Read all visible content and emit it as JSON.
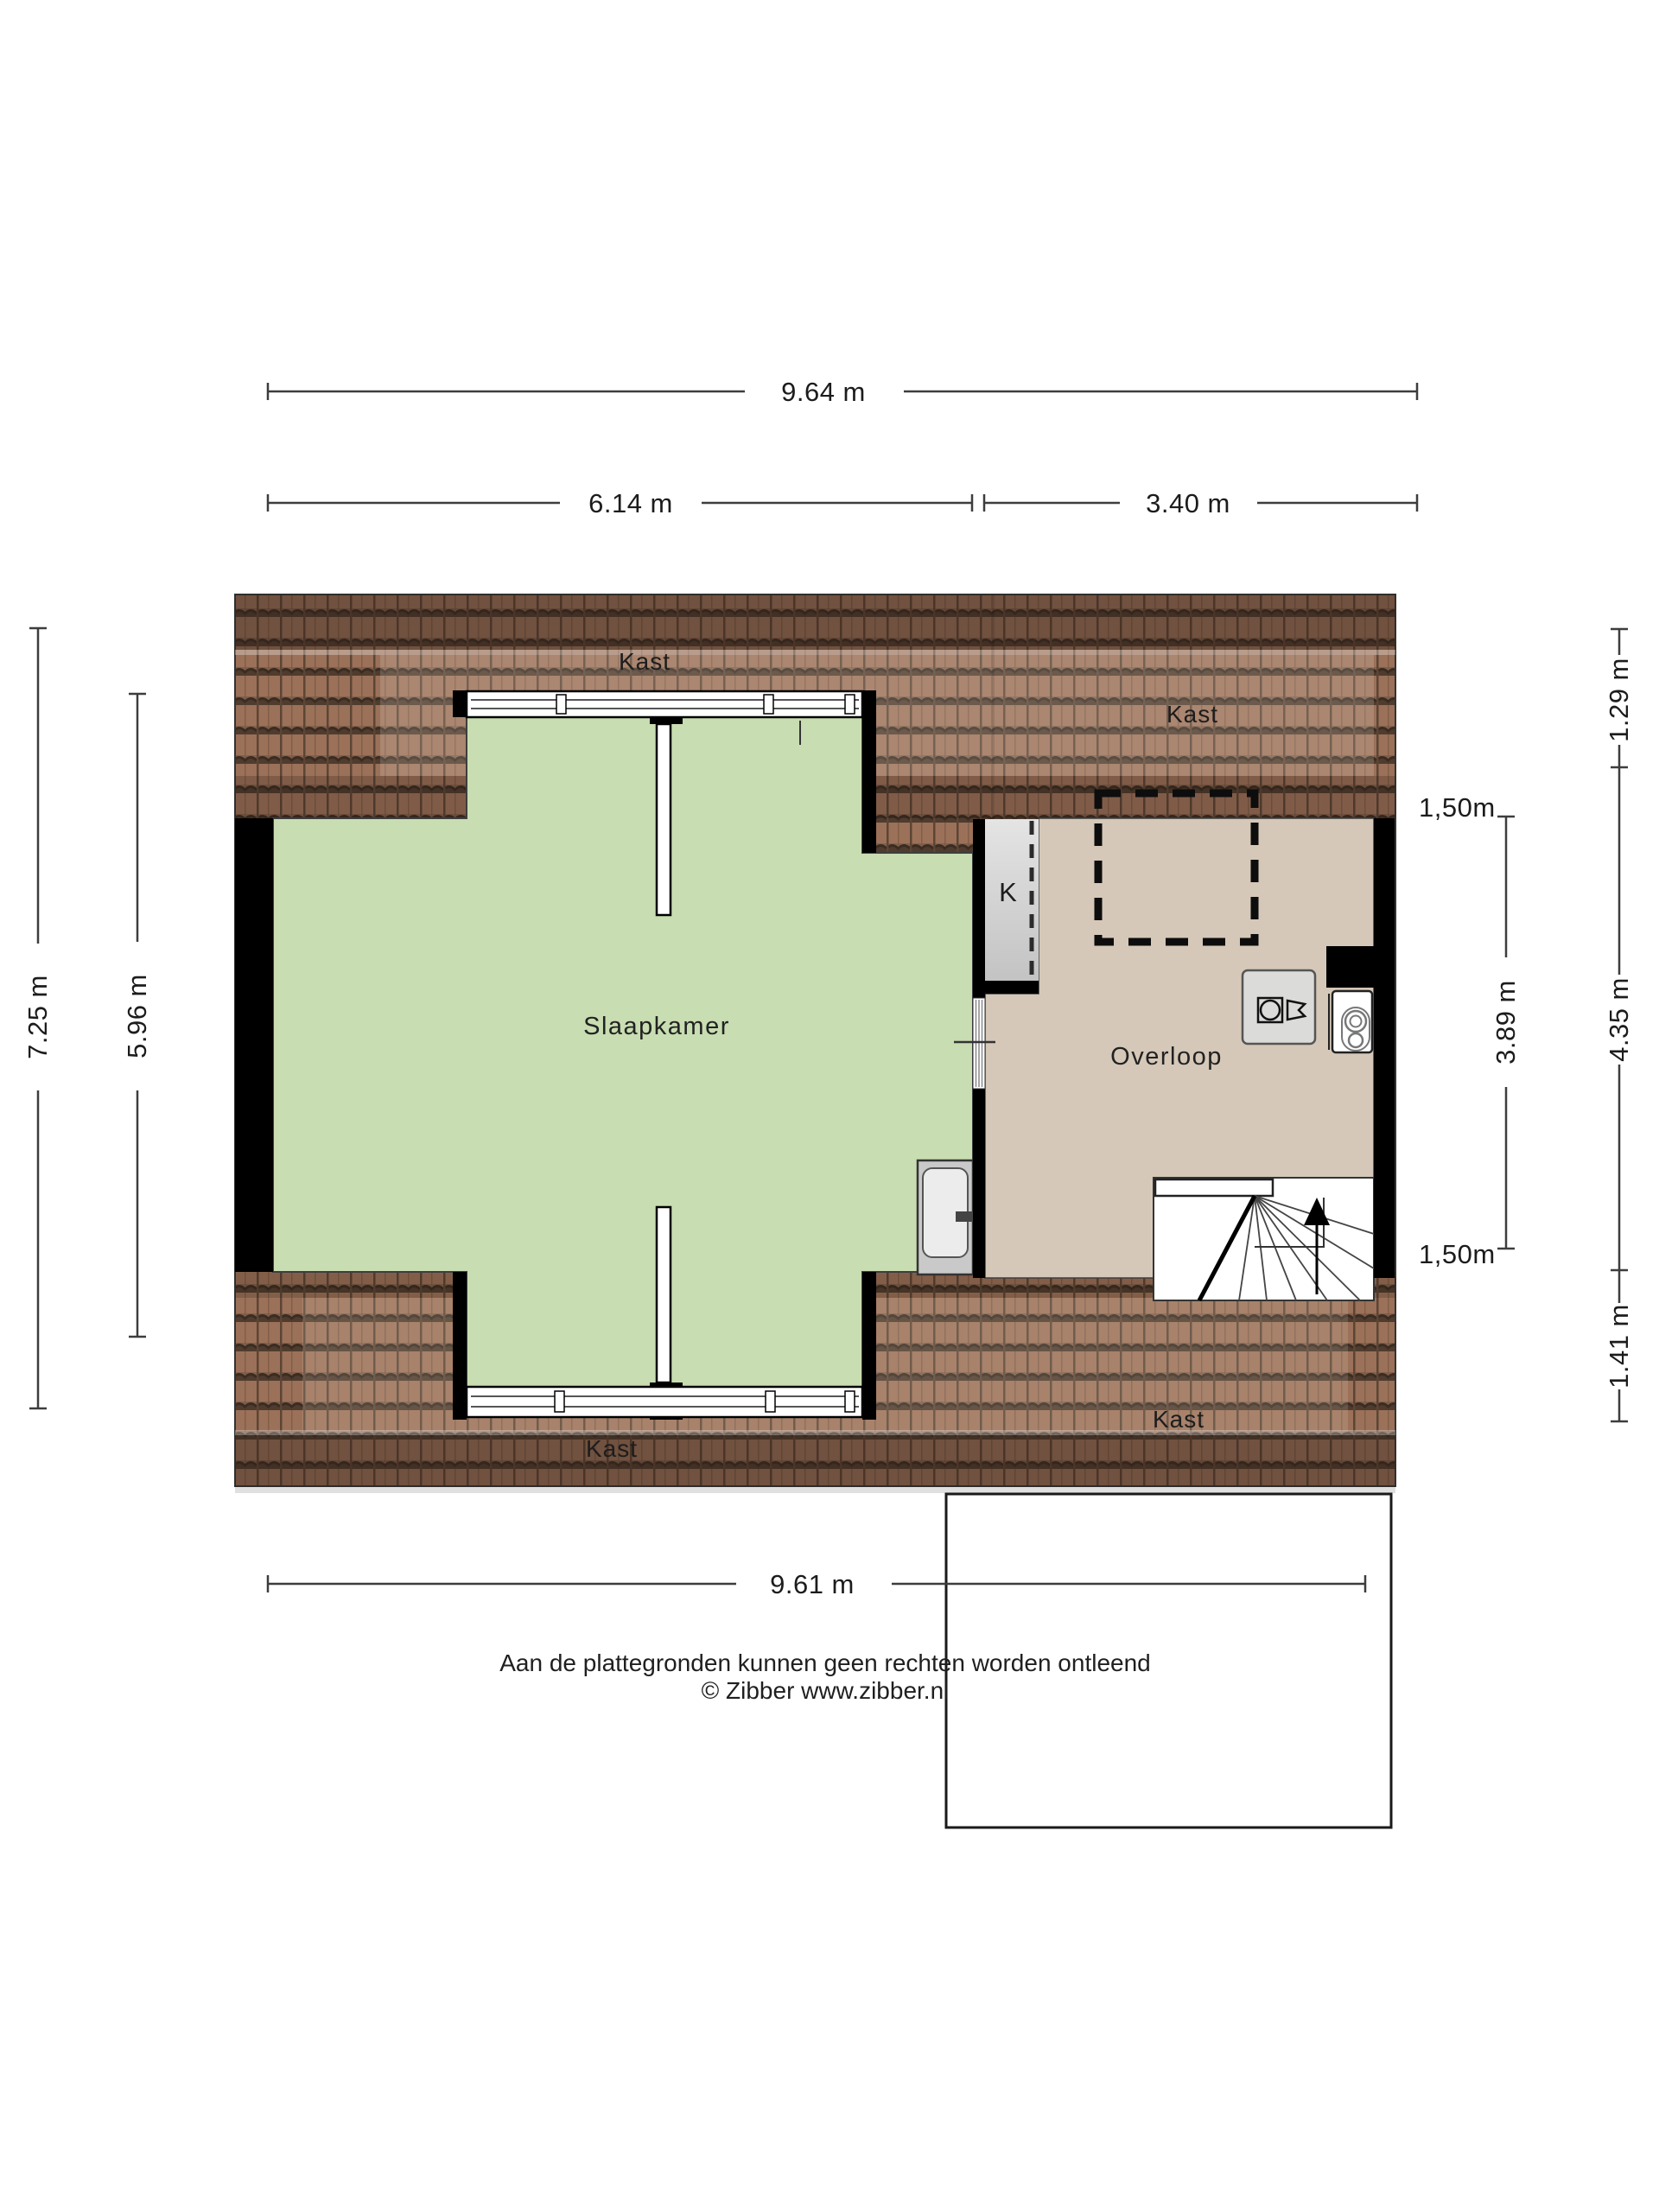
{
  "floorplan": {
    "labels": {
      "bedroom": "Slaapkamer",
      "landing": "Overloop",
      "closet_top_left": "Kast",
      "closet_top_right": "Kast",
      "closet_bottom_left": "Kast",
      "closet_bottom_right": "Kast",
      "closet_k": "K"
    },
    "dimensions": {
      "top_total": "9.64 m",
      "top_left": "6.14 m",
      "top_right": "3.40 m",
      "bottom_total": "9.61 m",
      "left_outer": "7.25 m",
      "left_inner": "5.96 m",
      "right_inner": "3.89 m",
      "right_top": "1.29 m",
      "right_middle": "4.35 m",
      "right_bottom": "1.41 m",
      "headroom_top": "1,50m",
      "headroom_bottom": "1,50m"
    },
    "disclaimer": {
      "line1": "Aan de plattegronden kunnen geen rechten worden ontleend",
      "line2": "© Zibber www.zibber.nl"
    },
    "colors": {
      "bedroom": "#c8ddb1",
      "landing": "#d5c8b8",
      "closet": "#d6d6d6",
      "roof_base": "#9b7159",
      "wall": "#000000",
      "fixture_gray": "#dbdbd9",
      "stairs": "#ffffff"
    }
  }
}
